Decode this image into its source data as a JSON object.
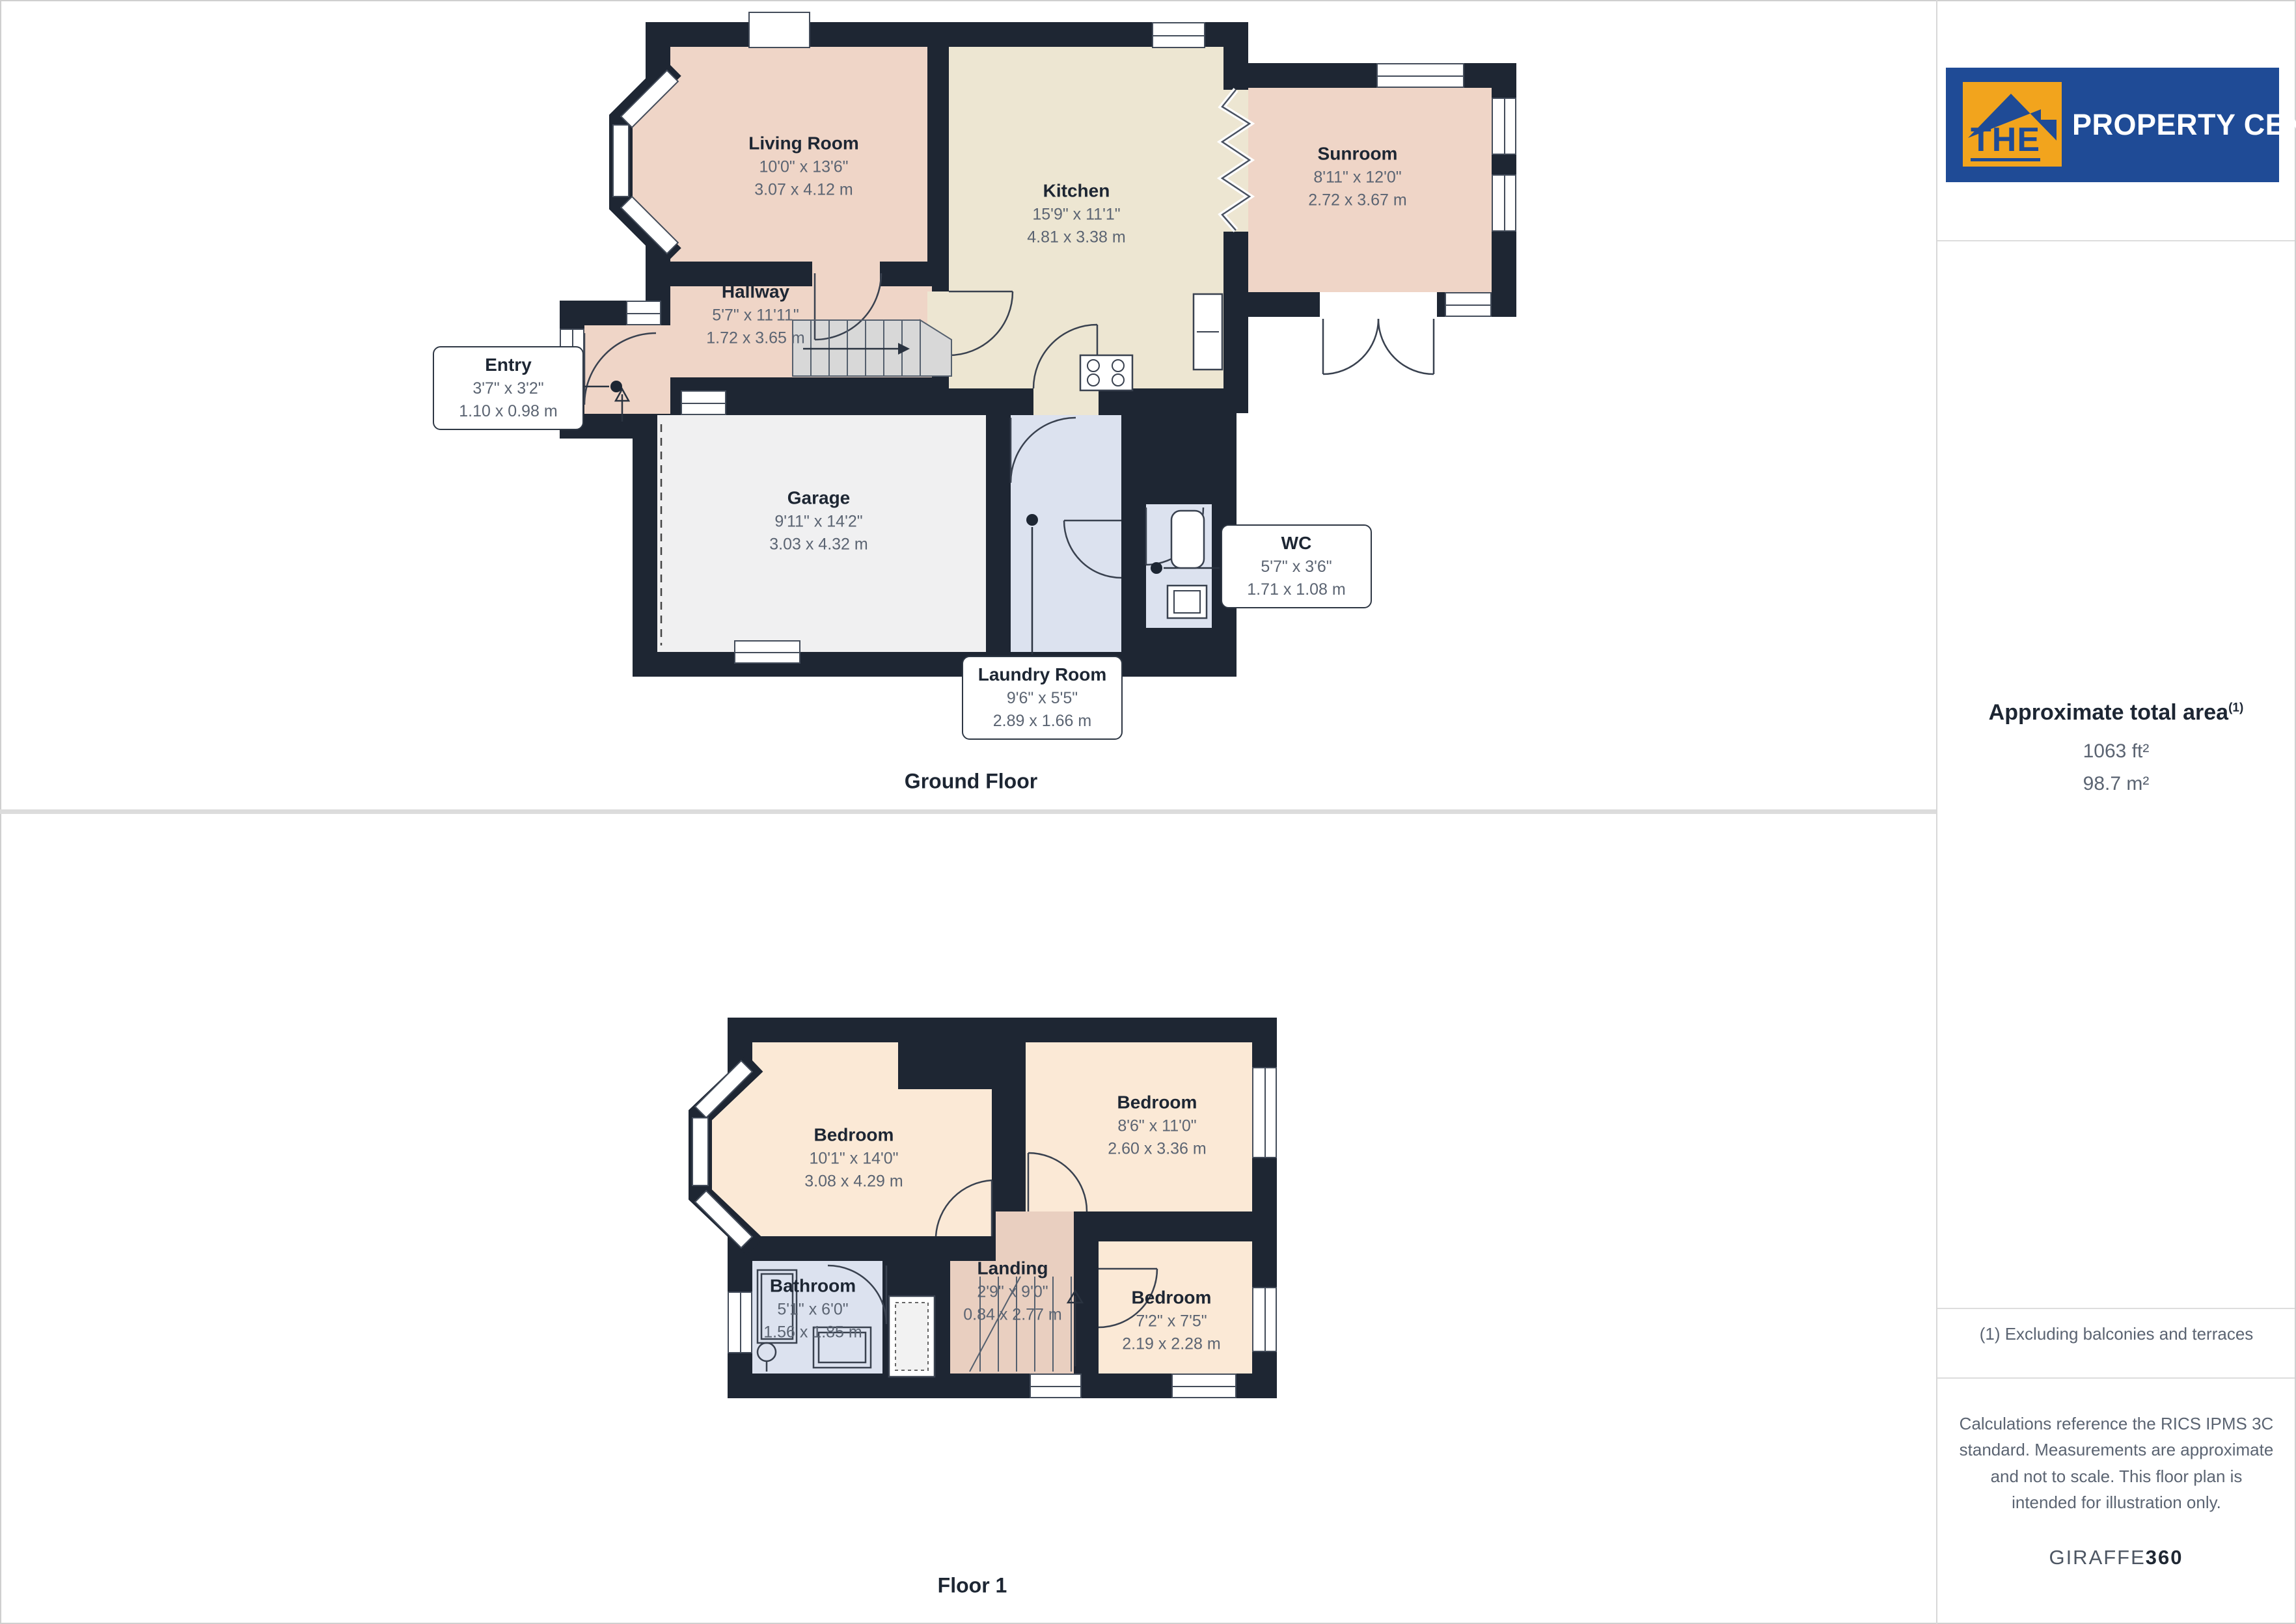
{
  "brand": {
    "logo_the": "THE",
    "logo_rest": "PROPERTY CENTRE"
  },
  "sidebar": {
    "area_heading": "Approximate total area",
    "area_sup": "(1)",
    "area_ft": "1063 ft²",
    "area_m": "98.7 m²",
    "footnote": "(1) Excluding balconies and terraces",
    "disclaimer": "Calculations reference the RICS IPMS 3C standard. Measurements are approximate and not to scale. This floor plan is intended for illustration only.",
    "giraffe": "GIRAFFE",
    "giraffe_suffix": "360"
  },
  "ground_floor": {
    "label": "Ground Floor",
    "rooms": {
      "living": {
        "name": "Living Room",
        "imperial": "10'0\" x 13'6\"",
        "metric": "3.07 x 4.12 m"
      },
      "kitchen": {
        "name": "Kitchen",
        "imperial": "15'9\" x 11'1\"",
        "metric": "4.81 x 3.38 m"
      },
      "sunroom": {
        "name": "Sunroom",
        "imperial": "8'11\" x 12'0\"",
        "metric": "2.72 x 3.67 m"
      },
      "hallway": {
        "name": "Hallway",
        "imperial": "5'7\" x 11'11\"",
        "metric": "1.72 x 3.65 m"
      },
      "entry": {
        "name": "Entry",
        "imperial": "3'7\" x 3'2\"",
        "metric": "1.10 x 0.98 m"
      },
      "garage": {
        "name": "Garage",
        "imperial": "9'11\" x 14'2\"",
        "metric": "3.03 x 4.32 m"
      },
      "wc": {
        "name": "WC",
        "imperial": "5'7\" x 3'6\"",
        "metric": "1.71 x 1.08 m"
      },
      "laundry": {
        "name": "Laundry Room",
        "imperial": "9'6\" x 5'5\"",
        "metric": "2.89 x 1.66 m"
      }
    }
  },
  "floor1": {
    "label": "Floor 1",
    "rooms": {
      "bedroom_large": {
        "name": "Bedroom",
        "imperial": "10'1\" x 14'0\"",
        "metric": "3.08 x 4.29 m"
      },
      "bedroom_right": {
        "name": "Bedroom",
        "imperial": "8'6\" x 11'0\"",
        "metric": "2.60 x 3.36 m"
      },
      "bedroom_small": {
        "name": "Bedroom",
        "imperial": "7'2\" x 7'5\"",
        "metric": "2.19 x 2.28 m"
      },
      "bathroom": {
        "name": "Bathroom",
        "imperial": "5'1\" x 6'0\"",
        "metric": "1.56 x 1.85 m"
      },
      "landing": {
        "name": "Landing",
        "imperial": "2'9\" x 9'0\"",
        "metric": "0.84 x 2.77 m"
      }
    }
  },
  "colors": {
    "wall": "#1E2633",
    "room_pink": "#EFD5C7",
    "room_beige": "#EDE6D2",
    "room_peach": "#FBE9D6",
    "room_tan": "#E9CFC0",
    "room_blue": "#DCE2EF",
    "room_gray": "#F0F0F1",
    "logo_blue": "#1F4B96",
    "logo_orange": "#F2A41D"
  }
}
